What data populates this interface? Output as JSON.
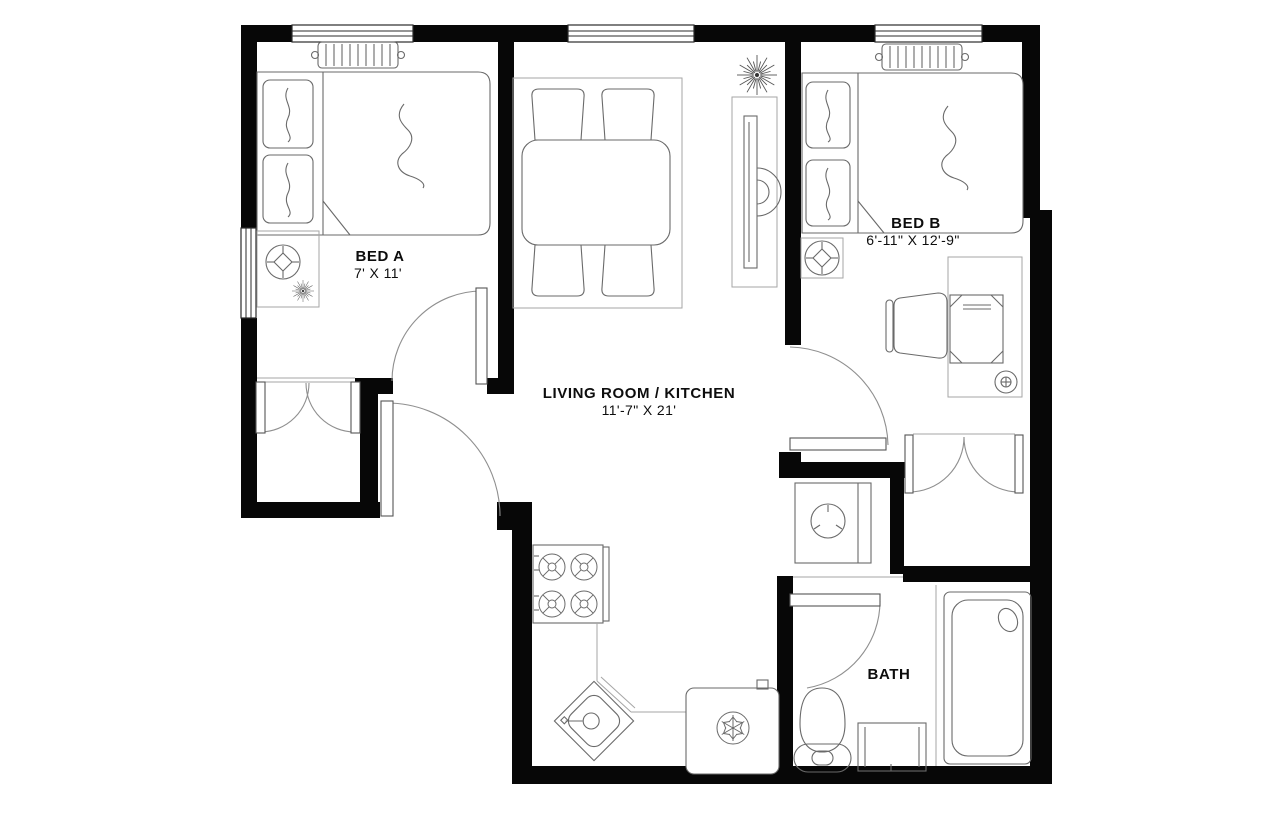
{
  "rooms": {
    "bed_a": {
      "name": "BED A",
      "dims": "7' X 11'"
    },
    "bed_b": {
      "name": "BED B",
      "dims": "6'-11\" X 12'-9\""
    },
    "living": {
      "name": "LIVING ROOM / KITCHEN",
      "dims": "11'-7\" X 21'"
    },
    "bath": {
      "name": "BATH"
    }
  },
  "colors": {
    "wall": "#070707",
    "furniture_line": "#6a6a6a",
    "light_line": "#a6a6a6",
    "background": "#ffffff",
    "text": "#0d0d0d"
  },
  "furniture": {
    "bed_a": [
      "double-bed",
      "pillows",
      "radiator",
      "window",
      "fan-side-table",
      "plant",
      "closet-double-doors",
      "door-swing"
    ],
    "living": [
      "area-rug",
      "dining-table",
      "four-chairs",
      "wall-tv",
      "plant",
      "entry-door-swing"
    ],
    "kitchen": [
      "range-four-burners",
      "corner-sink",
      "counter",
      "refrigerator"
    ],
    "bed_b": [
      "double-bed",
      "pillows",
      "radiator",
      "window",
      "fan-side-table",
      "desk",
      "laptop",
      "office-chair",
      "mug",
      "closet-french-doors",
      "door-swing"
    ],
    "utility": [
      "washing-machine"
    ],
    "bath": [
      "toilet",
      "vanity-cabinet",
      "bathtub",
      "door-swing"
    ]
  }
}
